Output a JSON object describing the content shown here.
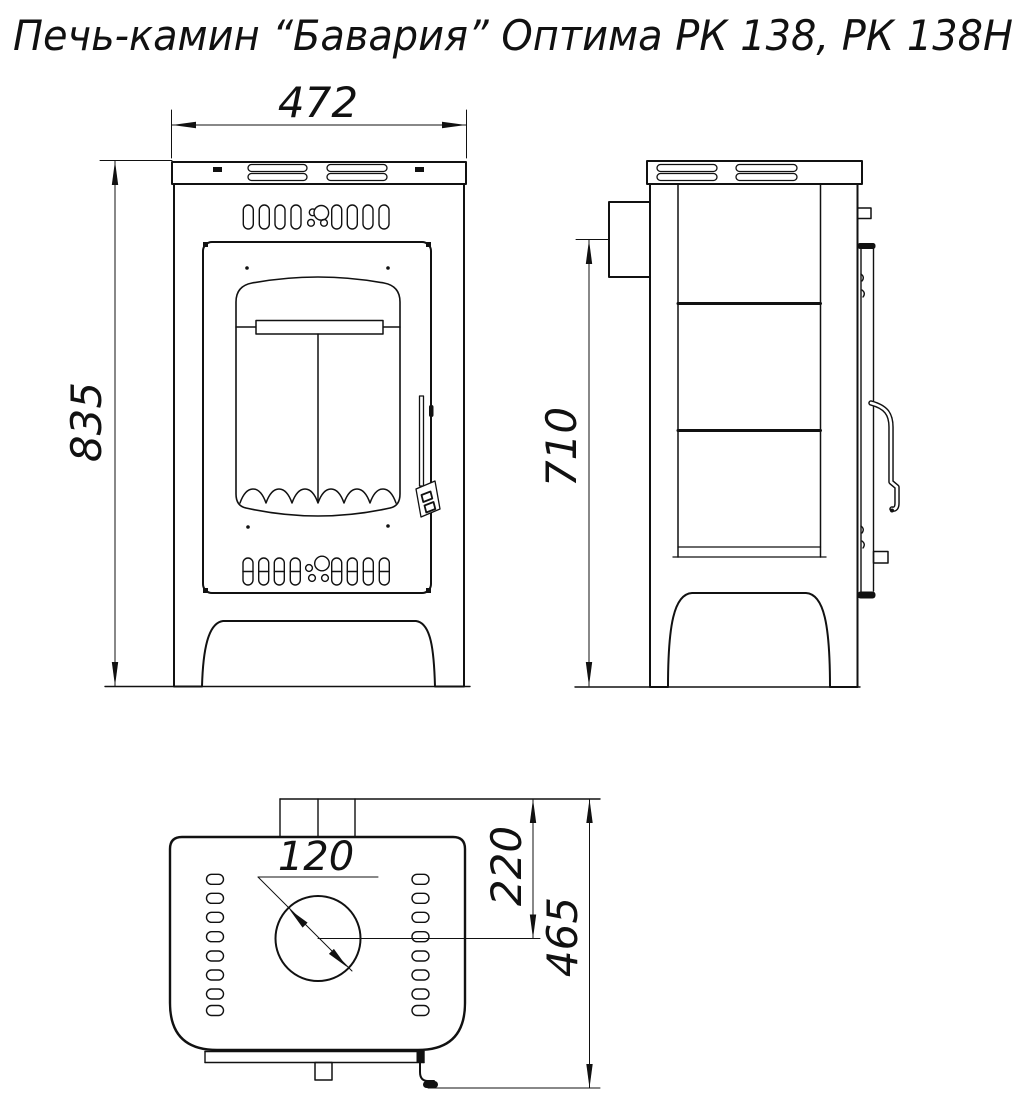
{
  "title": "Печь-камин “Бавария” Оптима РК 138, РК 138Н",
  "colors": {
    "line": "#111111",
    "background": "#ffffff"
  },
  "views": {
    "front": {
      "label": "Вид спереди",
      "dim_width": "472",
      "dim_height": "835"
    },
    "side": {
      "label": "Вид сбоку",
      "dim_outlet_height": "710"
    },
    "top": {
      "label": "Вид сверху",
      "dim_flue_diameter": "120",
      "dim_flue_offset": "220",
      "dim_depth": "465"
    }
  }
}
